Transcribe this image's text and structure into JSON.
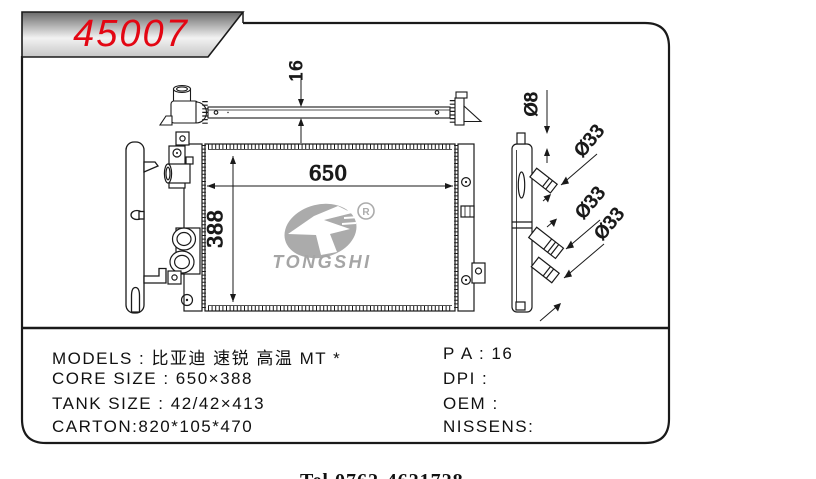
{
  "banner": {
    "part_number": "45007"
  },
  "dimensions": {
    "top_view_thickness": "16",
    "core_width": "650",
    "core_height": "388",
    "inlet_small_dia": "Ø8",
    "pipe_upper_dia": "Ø33",
    "pipe_middle_dia": "Ø33",
    "pipe_lower_dia": "Ø33"
  },
  "logo": {
    "brand": "TONGSHI",
    "registered_mark": "R"
  },
  "specs": {
    "left": [
      "MODELS : 比亚迪 速锐 高温 MT *",
      "CORE SIZE : 650×388",
      "TANK SIZE : 42/42×413",
      "CARTON:820*105*470"
    ],
    "right": [
      "P A : 16",
      "DPI :",
      "OEM :",
      "NISSENS:"
    ]
  },
  "footer": {
    "phone_partial": "Tel 0762-4621728"
  },
  "colors": {
    "accent_red": "#e30613",
    "logo_gray": "#a9a9a9",
    "line_black": "#1a1a1a"
  }
}
